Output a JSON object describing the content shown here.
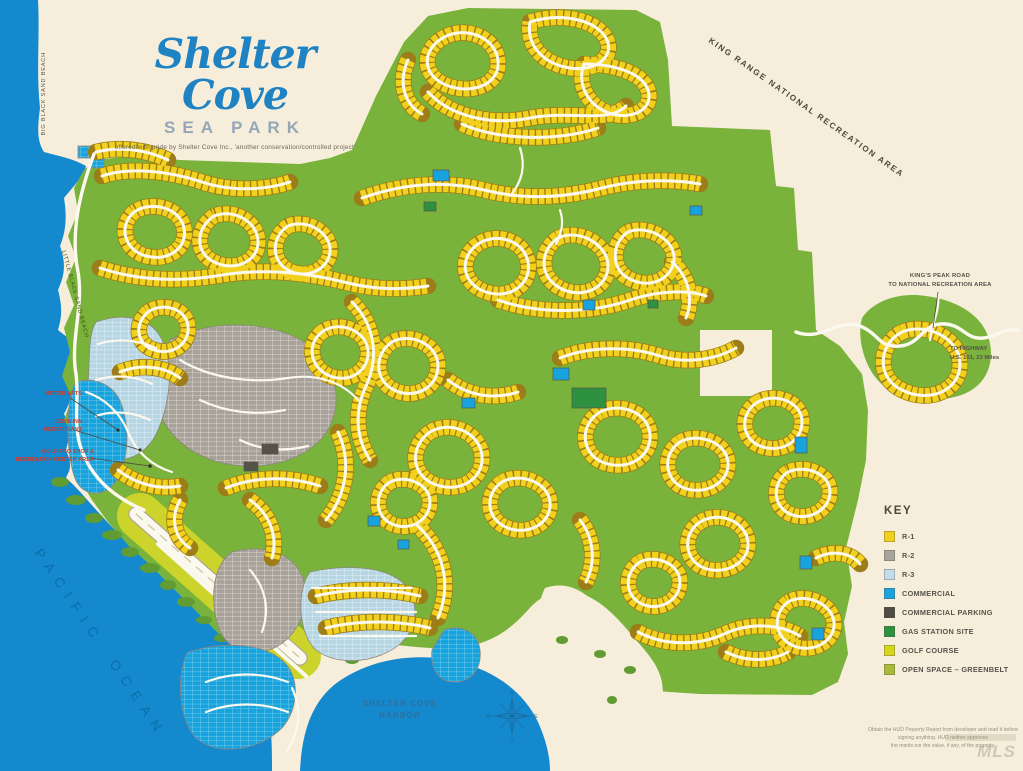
{
  "title_block": {
    "brand_script": "Shelter Cove",
    "brand_sub": "SEA PARK",
    "tagline": "offered with pride by Shelter Cove Inc., 'another conservation/controlled project'"
  },
  "region_labels": {
    "king_range": "KING RANGE NATIONAL RECREATION AREA",
    "kings_peak_road": [
      "KING'S PEAK ROAD",
      "TO NATIONAL RECREATION AREA"
    ],
    "to_highway": [
      "TO HIGHWAY",
      "U.S. 101, 23 Miles"
    ],
    "pacific_ocean": "PACIFIC OCEAN",
    "harbor": [
      "SHELTER COVE",
      "HARBOR"
    ],
    "big_black_sand_beach": "BIG BLACK SAND BEACH",
    "little_black_sand_beach": "LITTLE BLACK SAND BEACH"
  },
  "poi_labels": {
    "motor_apts": "MOTOR APTS",
    "cove_inn": [
      "COVE INN",
      "RESTAURANT"
    ],
    "rec_center": [
      "GOLF PRO SHOP &",
      "RECREATION CENTER AREA"
    ]
  },
  "legend": {
    "title": "KEY",
    "items": [
      {
        "label": "R-1",
        "color": "#f0d01e"
      },
      {
        "label": "R-2",
        "color": "#a9a49b"
      },
      {
        "label": "R-3",
        "color": "#c3dcea"
      },
      {
        "label": "COMMERCIAL",
        "color": "#1ba3de"
      },
      {
        "label": "COMMERCIAL PARKING",
        "color": "#4f4c45"
      },
      {
        "label": "GAS STATION SITE",
        "color": "#2e9140"
      },
      {
        "label": "GOLF COURSE",
        "color": "#d6d61f"
      },
      {
        "label": "OPEN SPACE – GREENBELT",
        "color": "#a9b93a"
      }
    ]
  },
  "compass": {
    "n": "N",
    "e": "E",
    "s": "S",
    "w": "W"
  },
  "disclaimer": {
    "lines": [
      "Obtain the HUD Property Report from developer and read it before",
      "signing anything. HUD neither approves",
      "the merits nor the value, if any, of the property."
    ]
  },
  "watermark": "MLS",
  "colors": {
    "paper": "#f6eedb",
    "ocean": "#1489cd",
    "ocean_text": "#0d6da9",
    "green": "#79b33c",
    "fringe": "#5f9c33",
    "lot_yellow": "#f2d11c",
    "lot_edge": "#9c7d18",
    "road_white": "#fbf8ee",
    "gray_r2": "#a8a29a",
    "blue_r3": "#b7d6e4",
    "commercial": "#17a4de",
    "parking": "#55524a",
    "gas_green": "#2e9140",
    "golf": "#ccd42c",
    "title_blue": "#1f82c3",
    "subtitle_blue": "#93a7b8",
    "red_label": "#cf3a28",
    "text_dark": "#4c483e"
  }
}
